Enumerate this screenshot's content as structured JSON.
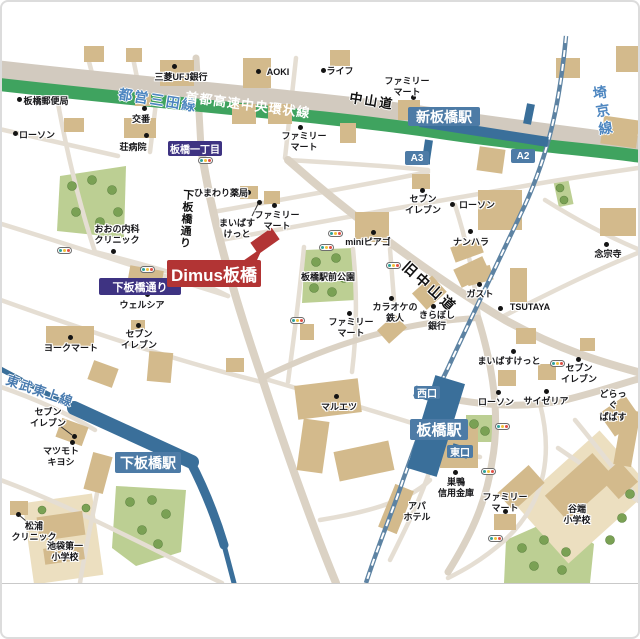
{
  "property": {
    "label": "Dimus板橋"
  },
  "stations": {
    "shin_itabashi": "新板橋駅",
    "itabashi": "板橋駅",
    "shimo_itabashi": "下板橋駅",
    "exit_a3": "A3",
    "exit_a2": "A2",
    "west_exit": "西口",
    "east_exit": "東口"
  },
  "railways": {
    "mita_line": "都営三田線",
    "saikyo_line": "埼京線",
    "tobu_tojo_line": "東武東上線"
  },
  "roads": {
    "shuto_expressway": "首都高速中央環状線",
    "nakasendo": "中山道",
    "kyu_nakasendo": "旧中山道",
    "shimo_itabashi_dori": "下板橋通り",
    "shimo_itabashi_dori_badge": "下板橋通り",
    "itabashi_itchome_badge": "板橋一丁目"
  },
  "pois": [
    {
      "text": "板橋郵便局"
    },
    {
      "text": "ローソン"
    },
    {
      "text": "交番"
    },
    {
      "text": "荘病院"
    },
    {
      "text": "三菱UFJ銀行"
    },
    {
      "text": "AOKI"
    },
    {
      "text": "ライフ"
    },
    {
      "text": "ファミリー\nマート"
    },
    {
      "text": "ひまわり薬局"
    },
    {
      "text": "ファミリー\nマート"
    },
    {
      "text": "まいばす\nけっと"
    },
    {
      "text": "ファミリー\nマート"
    },
    {
      "text": "おおの内科\nクリニック"
    },
    {
      "text": "ウェルシア"
    },
    {
      "text": "miniピアゴ"
    },
    {
      "text": "セブン\nイレブン"
    },
    {
      "text": "ローソン"
    },
    {
      "text": "ナンハラ"
    },
    {
      "text": "念宗寺"
    },
    {
      "text": "板橋駅前公園"
    },
    {
      "text": "カラオケの\n鉄人"
    },
    {
      "text": "きらぼし\n銀行"
    },
    {
      "text": "ガスト"
    },
    {
      "text": "TSUTAYA"
    },
    {
      "text": "ファミリー\nマート"
    },
    {
      "text": "ヨークマート"
    },
    {
      "text": "セブン\nイレブン"
    },
    {
      "text": "セブン\nイレブン"
    },
    {
      "text": "マツモト\nキヨシ"
    },
    {
      "text": "マルエツ"
    },
    {
      "text": "まいばすけっと"
    },
    {
      "text": "セブン\nイレブン"
    },
    {
      "text": "どらっぐ\nぱぱす"
    },
    {
      "text": "サイゼリア"
    },
    {
      "text": "ローソン"
    },
    {
      "text": "巣鴨\n信用金庫"
    },
    {
      "text": "ファミリー\nマート"
    },
    {
      "text": "アパ\nホテル"
    },
    {
      "text": "谷端\n小学校"
    },
    {
      "text": "松浦\nクリニック"
    },
    {
      "text": "池袋第一\n小学校"
    }
  ],
  "colors": {
    "expressway_green": "#3fa35f",
    "rail_blue": "#3a6f9a",
    "station_badge_blue": "#4d7ba6",
    "property_red": "#b23434",
    "road_badge_purple": "#3e3382",
    "park_green": "#bccf93",
    "building_tan": "#d3ba8c"
  }
}
